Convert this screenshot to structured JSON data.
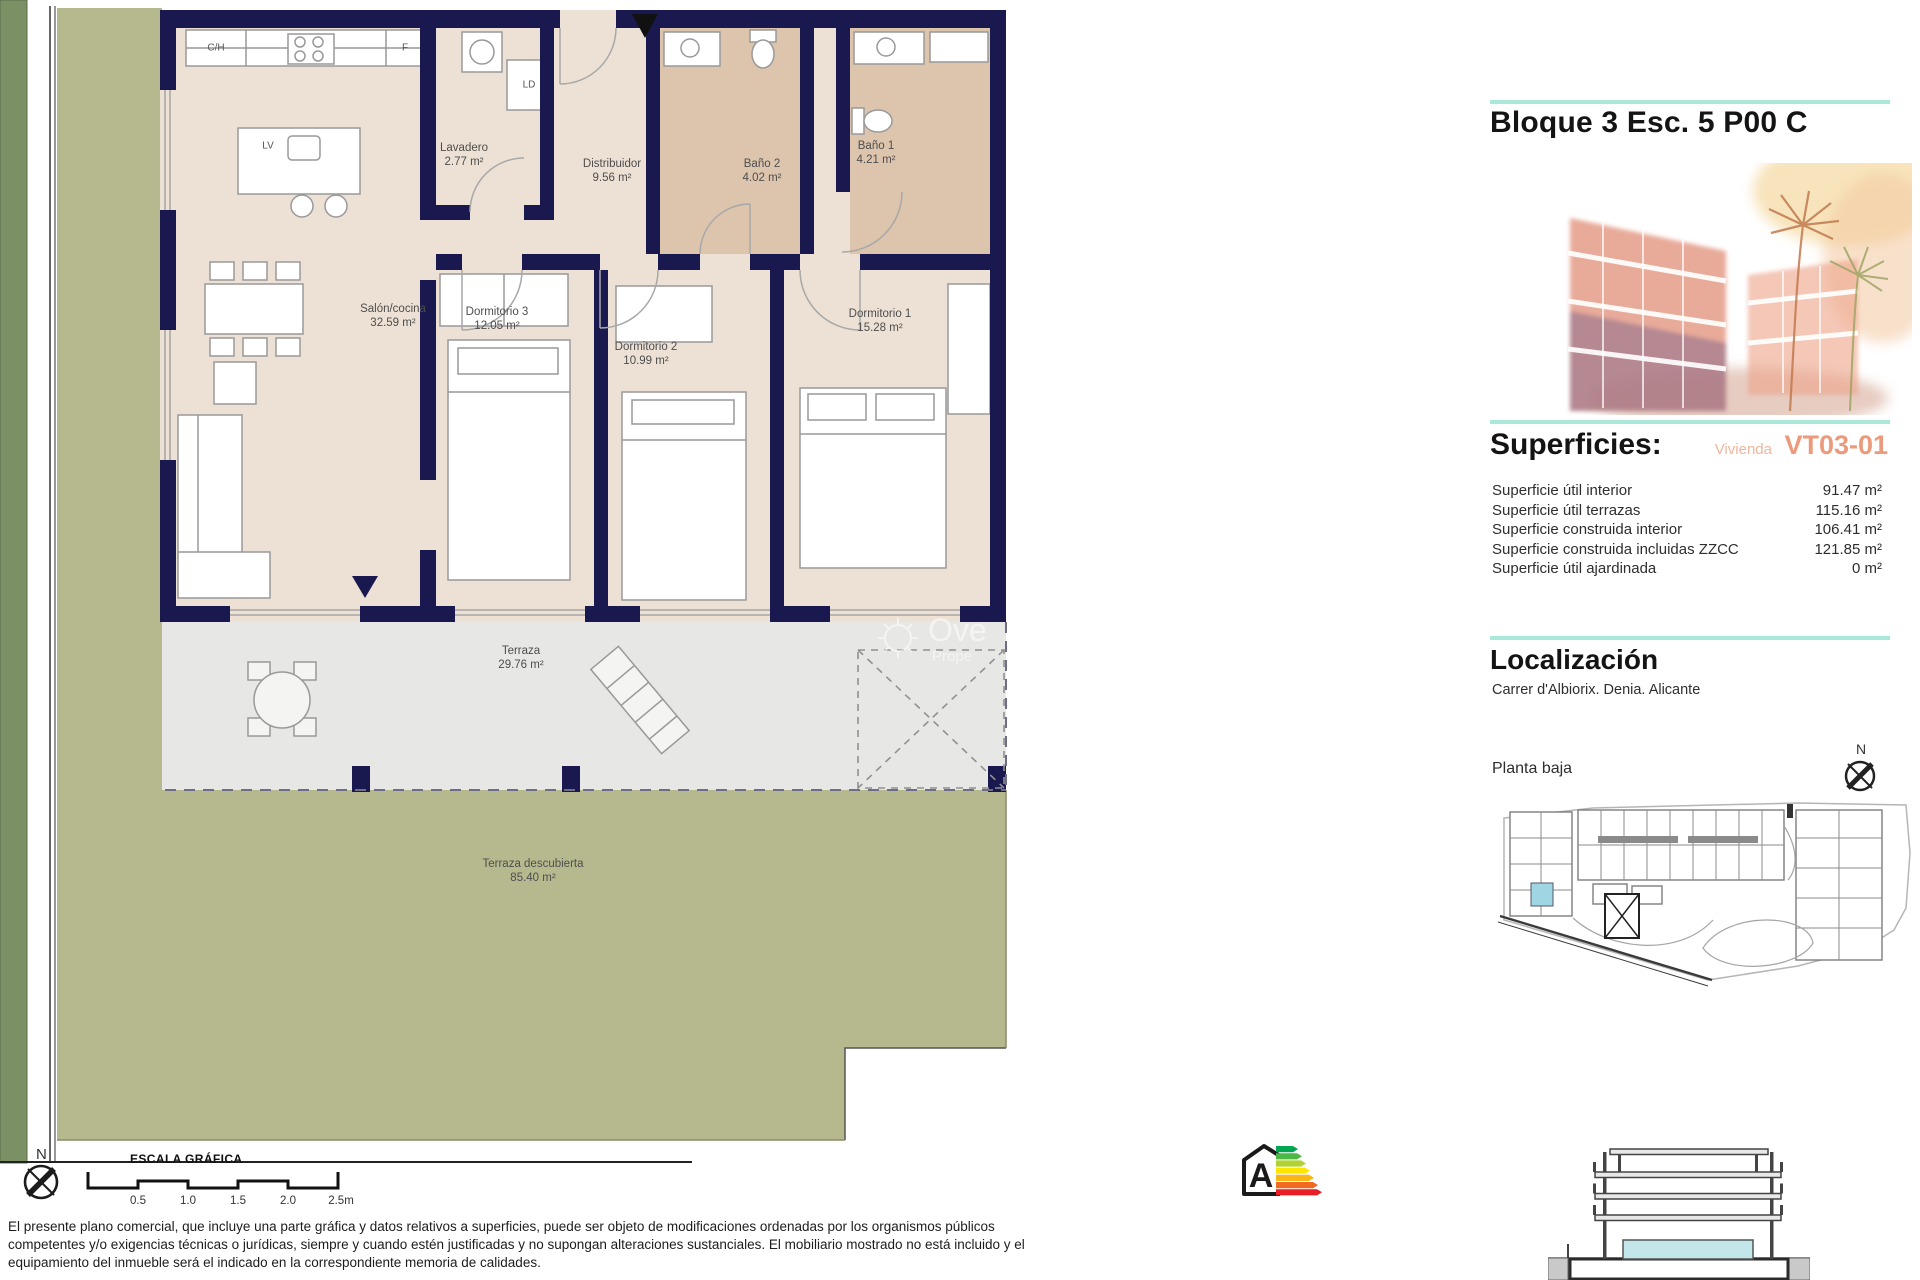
{
  "title": "Bloque 3 Esc. 5 P00 C",
  "superficies": {
    "title": "Superficies:",
    "vivienda_label": "Vivienda",
    "vivienda_code": "VT03-01",
    "rows": [
      {
        "label": "Superficie útil interior",
        "value": "91.47 m²"
      },
      {
        "label": "Superficie útil terrazas",
        "value": "115.16 m²"
      },
      {
        "label": "Superficie construida interior",
        "value": "106.41 m²"
      },
      {
        "label": "Superficie construida incluidas ZZCC",
        "value": "121.85 m²"
      },
      {
        "label": "Superficie útil ajardinada",
        "value": "0 m²"
      }
    ]
  },
  "localizacion": {
    "title": "Localización",
    "address": "Carrer d'Albiorix. Denia. Alicante"
  },
  "site_plan": {
    "label": "Planta baja",
    "north": "N"
  },
  "plan": {
    "north": "N",
    "rooms": [
      {
        "name": "Salón/cocina",
        "area": "32.59 m²"
      },
      {
        "name": "Dormitorio 3",
        "area": "12.05 m²"
      },
      {
        "name": "Dormitorio 2",
        "area": "10.99 m²"
      },
      {
        "name": "Dormitorio 1",
        "area": "15.28 m²"
      },
      {
        "name": "Lavadero",
        "area": "2.77 m²"
      },
      {
        "name": "Distribuidor",
        "area": "9.56 m²"
      },
      {
        "name": "Baño 2",
        "area": "4.02 m²"
      },
      {
        "name": "Baño 1",
        "area": "4.21 m²"
      },
      {
        "name": "Terraza",
        "area": "29.76 m²"
      },
      {
        "name": "Terraza descubierta",
        "area": "85.40 m²"
      }
    ],
    "fixtures": {
      "ch": "C/H",
      "f": "F",
      "lv": "LV",
      "ld": "LD"
    }
  },
  "scale_bar": {
    "title": "ESCALA GRÁFICA",
    "ticks": [
      "0.5",
      "1.0",
      "1.5",
      "2.0",
      "2.5m"
    ]
  },
  "energy_rating": {
    "letter": "A"
  },
  "watermark": {
    "line1": "Ove",
    "line2": "Prope"
  },
  "disclaimer_lines": [
    "El presente plano comercial, que incluye una parte gráfica y datos relativos a superficies, puede ser objeto de modificaciones ordenadas por los organismos públicos",
    "competentes y/o exigencias técnicas o jurídicas, siempre y cuando estén justificadas y no supongan alteraciones sustanciales. El mobiliario mostrado no está incluido y el",
    "equipamiento del inmueble será el indicado en la correspondiente memoria de calidades."
  ],
  "colors": {
    "accent_teal": "#a9e9dc",
    "salmon": "#eb9a7b",
    "wall_navy": "#191950",
    "floor_beige": "#ede1d5",
    "bath_tan": "#dcc4ad",
    "terrace_gray": "#e7e7e5",
    "garden_sage": "#b6b98e",
    "edge_green": "#7b9065",
    "highlight_blue": "#9fd6e3"
  }
}
